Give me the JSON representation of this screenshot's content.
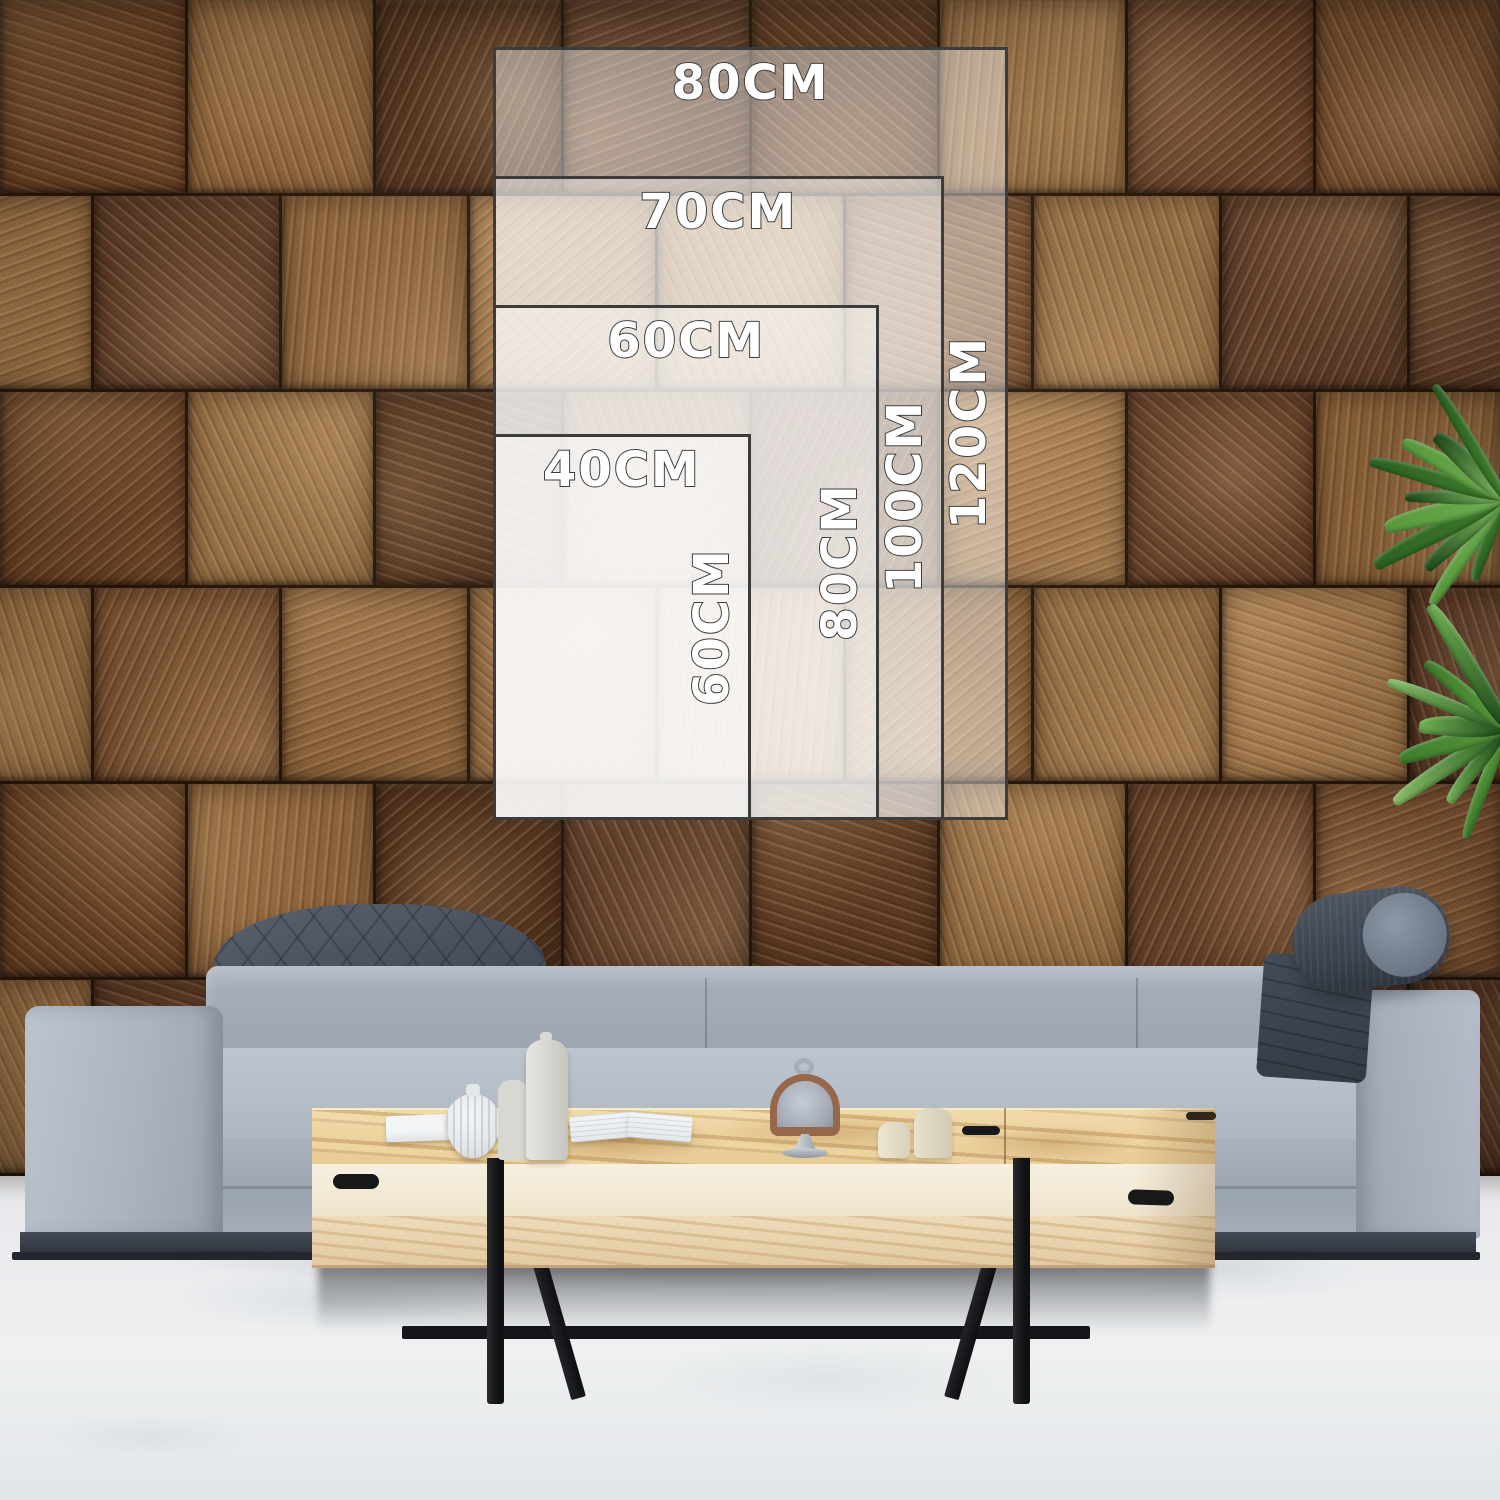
{
  "size_guide": {
    "unit": "CM",
    "sizes": [
      {
        "width_label": "80CM",
        "height_label": "120CM",
        "width_cm": 80,
        "height_cm": 120
      },
      {
        "width_label": "70CM",
        "height_label": "100CM",
        "width_cm": 70,
        "height_cm": 100
      },
      {
        "width_label": "60CM",
        "height_label": "80CM",
        "width_cm": 60,
        "height_cm": 80
      },
      {
        "width_label": "40CM",
        "height_label": "60CM",
        "width_cm": 40,
        "height_cm": 60
      }
    ],
    "text_color": "#ffffff",
    "text_outline": "#3e3e3e",
    "frame_border": "#3c3c3c",
    "fill": "rgba(255,255,255,0.42)",
    "fill_front": "rgba(255,255,255,0.52)"
  },
  "scene": {
    "wall": {
      "block_colors": [
        "#6a4326",
        "#7b5232",
        "#593720",
        "#8b6139",
        "#74492b",
        "#946c42",
        "#4f301b",
        "#a0764a",
        "#66412a",
        "#5d3c28"
      ],
      "grain_angles": [
        18,
        72,
        115,
        160,
        40,
        95,
        140,
        65
      ]
    },
    "floor_color": "#e9ebed",
    "sofa": {
      "fabric": "#aab3bd",
      "fabric_light": "#bcc5cf",
      "fabric_dark": "#8e98a4",
      "headrest_dark": "#454c58",
      "base": "#3a4049"
    },
    "table": {
      "top_wood": "#eccf9c",
      "front_cream": "#f4ebd8",
      "front_wood": "#e9d5b1",
      "legs": "#17181a"
    },
    "plant": {
      "leaf_colors": [
        "#2c6123",
        "#3f7d2c",
        "#58983c",
        "#6fae52",
        "#1f4a1a",
        "#86bd66"
      ],
      "clusters": [
        {
          "cx": 1504,
          "cy": 500,
          "leaves": 10
        },
        {
          "cx": 1506,
          "cy": 730,
          "leaves": 8
        }
      ]
    }
  }
}
